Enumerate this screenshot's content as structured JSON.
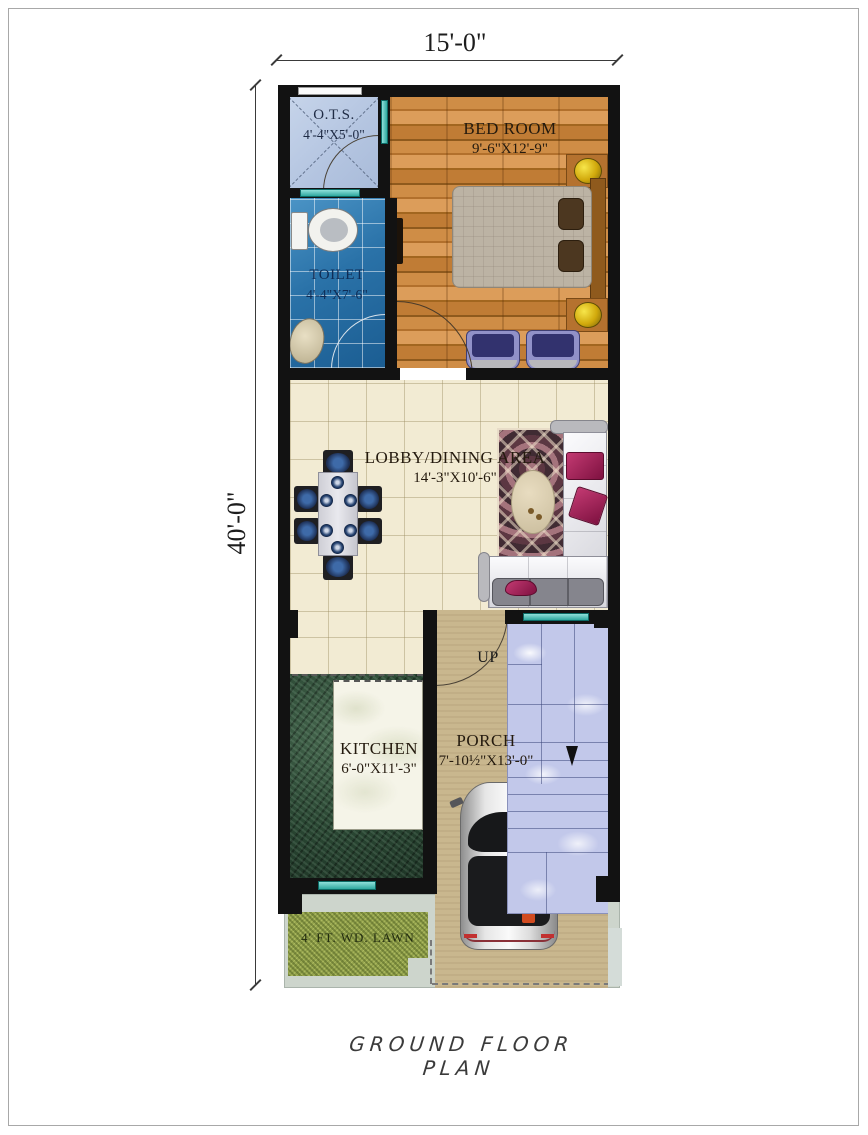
{
  "title": "GROUND FLOOR PLAN",
  "dimensions": {
    "width_label": "15'-0\"",
    "height_label": "40'-0\""
  },
  "rooms": {
    "ots": {
      "name": "O.T.S.",
      "size": "4'-4\"X5'-0\""
    },
    "bedroom": {
      "name": "BED ROOM",
      "size": "9'-6\"X12'-9\""
    },
    "toilet": {
      "name": "TOILET",
      "size": "4'-4\"X7'-6\""
    },
    "lobby": {
      "name": "LOBBY/DINING AREA",
      "size": "14'-3\"X10'-6\""
    },
    "kitchen": {
      "name": "KITCHEN",
      "size": "6'-0\"X11'-3\""
    },
    "porch": {
      "name": "PORCH",
      "size": "7'-10½\"X13'-0\""
    },
    "lawn": {
      "name": "4' FT. WD. LAWN"
    }
  },
  "annotations": {
    "stairs_direction": "UP"
  },
  "colors": {
    "wall": "#121212",
    "wood_floor": "#c9853f",
    "toilet_tile": "#2b74ab",
    "ots_floor": "#bccbe4",
    "lobby_tile": "#f2ebd3",
    "kitchen_counter": "#2c4a38",
    "stairs_marble": "#c2c8ea",
    "porch_floor": "#c9b78e",
    "lawn_green": "#93a24c",
    "sofa_accent": "#a82458",
    "window_teal": "#5ec6bd",
    "lamp_gold": "#d9b511"
  }
}
